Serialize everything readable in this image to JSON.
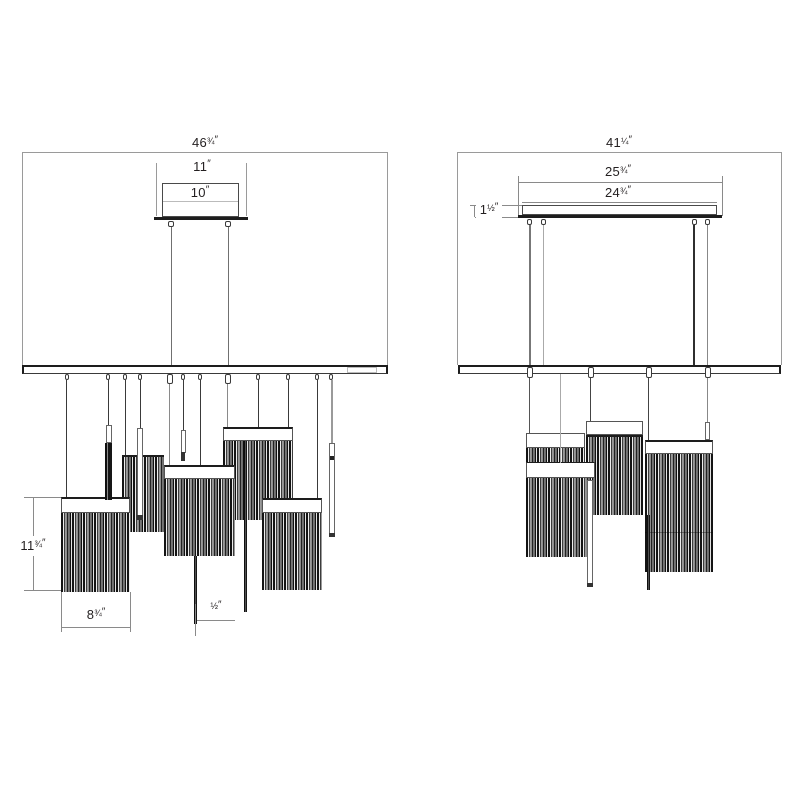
{
  "drawing": {
    "title": "pendant-chandelier-dimension-drawing",
    "views": {
      "front": {
        "name": "front elevation",
        "dims": {
          "overall_width": {
            "whole": "46",
            "frac": "¾",
            "unit": "″"
          },
          "plate_width": {
            "whole": "11",
            "frac": "",
            "unit": "″"
          },
          "canopy_width": {
            "whole": "10",
            "frac": "",
            "unit": "″"
          },
          "shade_height": {
            "whole": "11",
            "frac": "¾",
            "unit": "″"
          },
          "shade_width": {
            "whole": "8",
            "frac": "¾",
            "unit": "″"
          },
          "rod_width": {
            "whole": "",
            "frac": "½",
            "unit": "″"
          }
        }
      },
      "side": {
        "name": "side elevation",
        "dims": {
          "overall_width": {
            "whole": "41",
            "frac": "¼",
            "unit": "″"
          },
          "plate_outer_width": {
            "whole": "25",
            "frac": "¾",
            "unit": "″"
          },
          "plate_inner_width": {
            "whole": "24",
            "frac": "¾",
            "unit": "″"
          },
          "plate_height": {
            "whole": "1",
            "frac": "½",
            "unit": "″"
          }
        }
      }
    },
    "colors": {
      "line": "#1d1d1d",
      "dimension_line": "#8a8a8a",
      "cable": "#3a3a3a",
      "background": "#ffffff"
    }
  }
}
